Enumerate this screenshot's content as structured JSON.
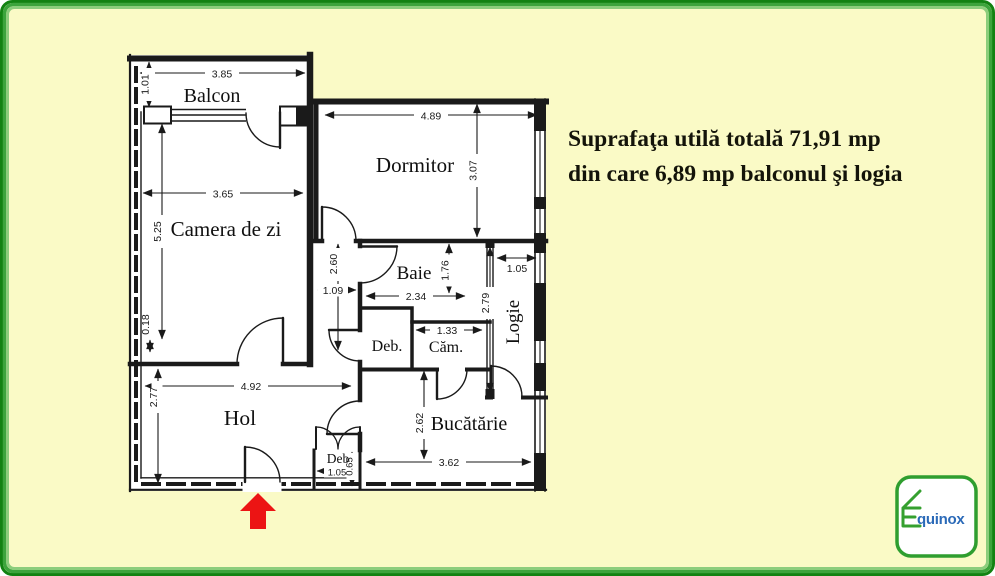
{
  "colors": {
    "background": "#fafac6",
    "frame_outer_green": "#128212",
    "frame_mid_green": "#3ca43c",
    "frame_inner_green": "#8ccd7c",
    "plan_line": "#1a1a1a",
    "arrow_red": "#ec1414",
    "logo_green": "#35a02f",
    "logo_blue": "#2b6ab8"
  },
  "annotation": {
    "line1": "Suprafaţa utilă totală 71,91 mp",
    "line2": "din care 6,89 mp balconul şi logia"
  },
  "rooms": {
    "balcon": "Balcon",
    "camera_de_zi": "Camera de zi",
    "dormitor": "Dormitor",
    "baie": "Baie",
    "deb_mid": "Deb.",
    "cam": "Căm.",
    "logie": "Logie",
    "hol": "Hol",
    "bucatarie": "Bucătărie",
    "deb_bottom": "Deb"
  },
  "dims": {
    "balcon_width": "3.85",
    "balcon_depth": "1.01",
    "camera_width": "3.65",
    "camera_height": "5.25",
    "camera_offset": "0.18",
    "dormitor_width": "4.89",
    "dormitor_height": "3.07",
    "corridor_height": "2.60",
    "corridor_width": "1.09",
    "baie_width": "2.34",
    "baie_height": "1.76",
    "cam_width": "1.33",
    "logie_width": "1.05",
    "logie_height": "2.79",
    "hol_width": "4.92",
    "hol_height": "2.77",
    "bucatarie_height": "2.62",
    "bucatarie_width": "3.62",
    "deb_width": "1.05",
    "deb_height": "0.65"
  },
  "logo": {
    "brand_suffix": "quinox"
  }
}
